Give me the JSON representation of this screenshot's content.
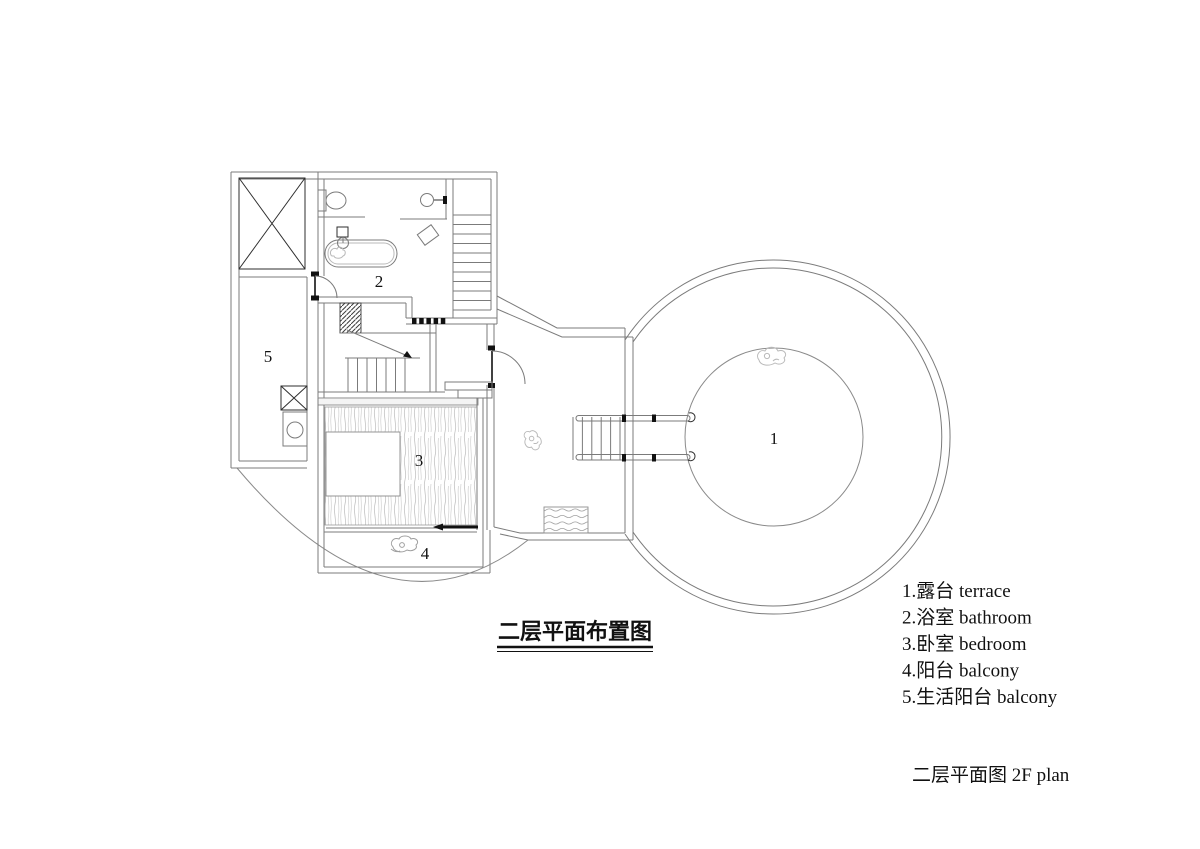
{
  "plan": {
    "title": "二层平面布置图",
    "caption": "二层平面图 2F plan",
    "room_labels": {
      "terrace": "1",
      "bathroom": "2",
      "bedroom": "3",
      "balcony": "4",
      "living_balcony": "5"
    },
    "legend": {
      "items": [
        {
          "text": "1.露台 terrace"
        },
        {
          "text": "2.浴室 bathroom"
        },
        {
          "text": "3.卧室 bedroom"
        },
        {
          "text": "4.阳台 balcony"
        },
        {
          "text": "5.生活阳台 balcony"
        }
      ]
    },
    "colors": {
      "wall_line": "#7b7b7b",
      "dark_line": "#1d1d1d",
      "light_line": "#b9b9b9",
      "background": "#ffffff"
    }
  }
}
